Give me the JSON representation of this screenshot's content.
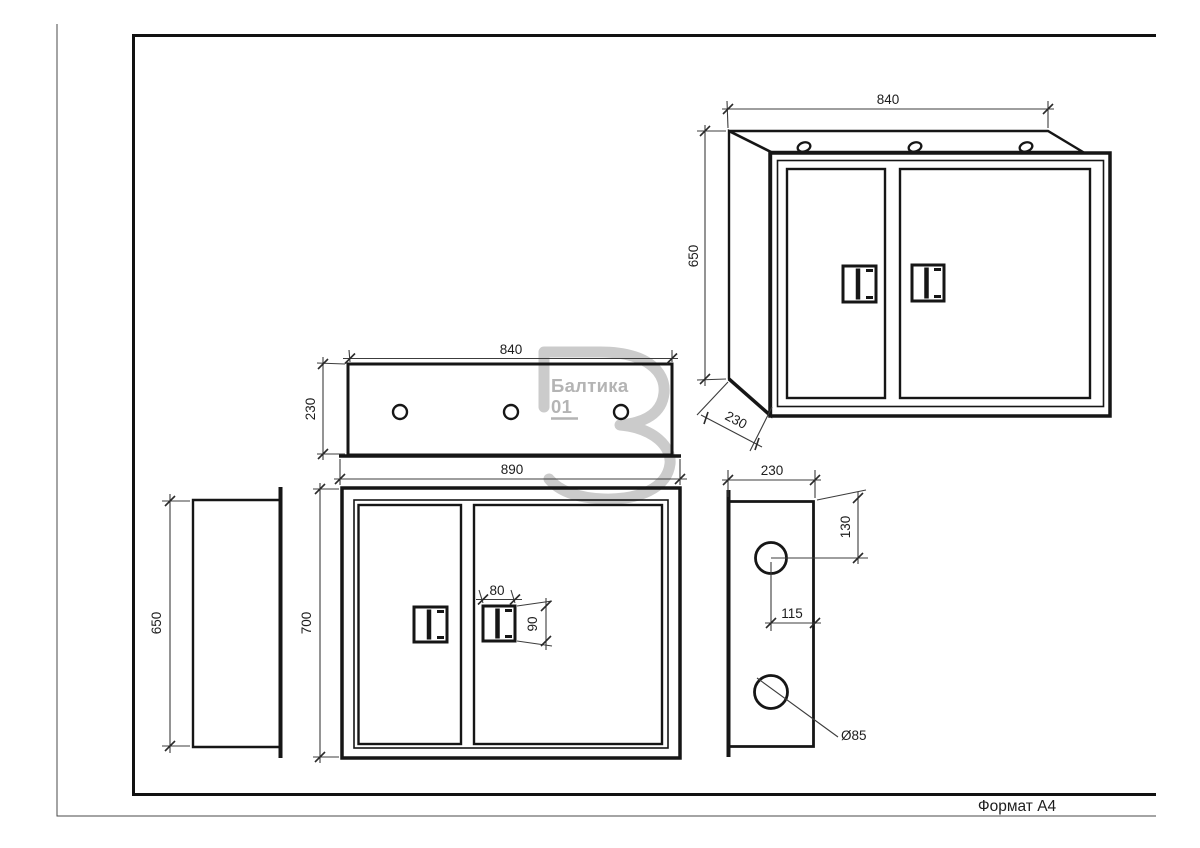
{
  "sheet": {
    "format_label": "Формат A4"
  },
  "watermark": {
    "brand": "Балтика",
    "number": "01"
  },
  "views": {
    "perspective": {
      "width": "840",
      "height": "650",
      "depth": "230"
    },
    "top": {
      "width": "840",
      "depth": "230"
    },
    "front": {
      "width": "890",
      "height": "700",
      "handle_width": "80",
      "handle_height": "90"
    },
    "side_panel": {
      "height": "650"
    },
    "side": {
      "depth": "230",
      "top_hole_offset": "130",
      "hole_center_offset": "115",
      "hole_diameter": "Ø85"
    }
  }
}
